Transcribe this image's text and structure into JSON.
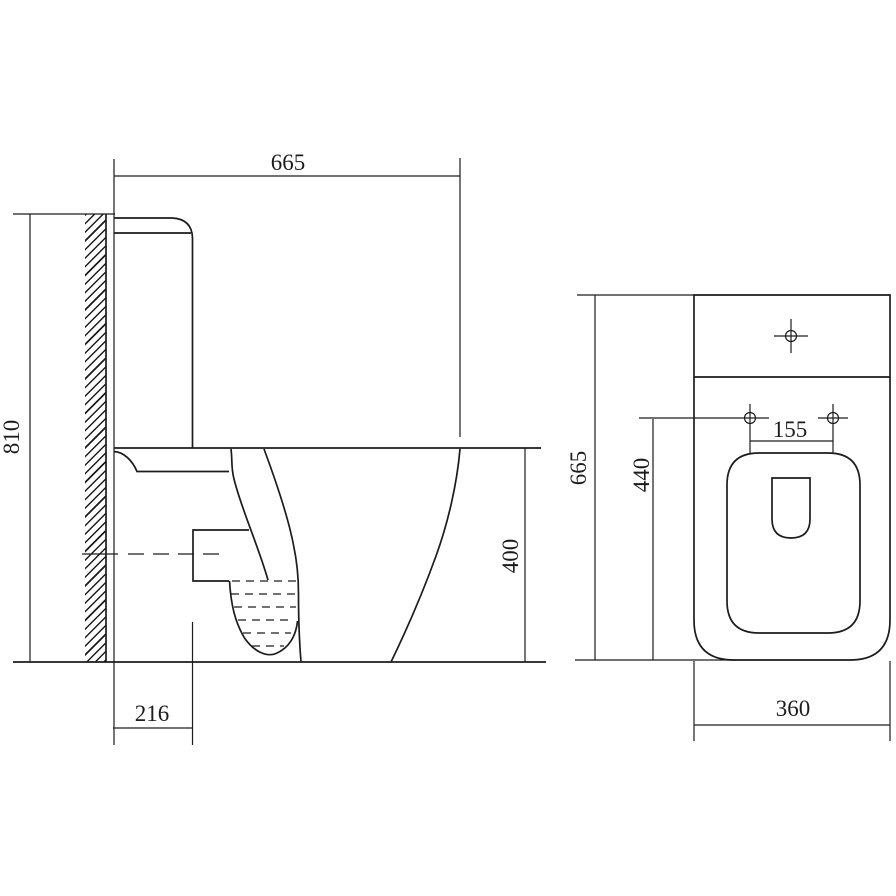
{
  "background_color": "#ffffff",
  "line_color": "#1c1c1c",
  "views": {
    "side": {
      "label_overall_depth": "665",
      "label_overall_height": "810",
      "label_bowl_height": "400",
      "label_outlet_setout": "216"
    },
    "plan": {
      "label_overall_length": "665",
      "label_bowl_length": "440",
      "label_hole_spacing": "155",
      "label_overall_width": "360"
    }
  }
}
